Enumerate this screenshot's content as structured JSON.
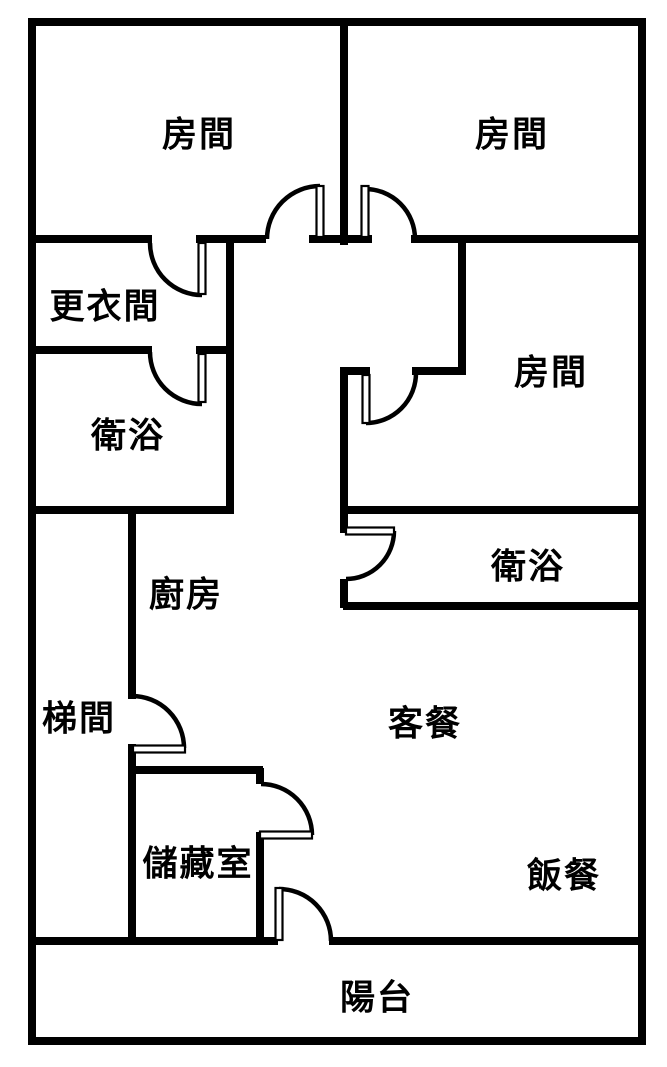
{
  "colors": {
    "background": "#ffffff",
    "wall": "#000000",
    "text": "#000000"
  },
  "rooms": [
    {
      "id": "bedroom-top-left",
      "label": "房間"
    },
    {
      "id": "bedroom-top-right",
      "label": "房間"
    },
    {
      "id": "dressing-room",
      "label": "更衣間"
    },
    {
      "id": "bathroom-left",
      "label": "衛浴"
    },
    {
      "id": "bedroom-right",
      "label": "房間"
    },
    {
      "id": "bathroom-right",
      "label": "衛浴"
    },
    {
      "id": "kitchen",
      "label": "廚房"
    },
    {
      "id": "stairwell",
      "label": "梯間"
    },
    {
      "id": "living-dining",
      "label": "客餐"
    },
    {
      "id": "storage-room",
      "label": "儲藏室"
    },
    {
      "id": "dining-area",
      "label": "飯餐"
    },
    {
      "id": "balcony",
      "label": "陽台"
    }
  ]
}
